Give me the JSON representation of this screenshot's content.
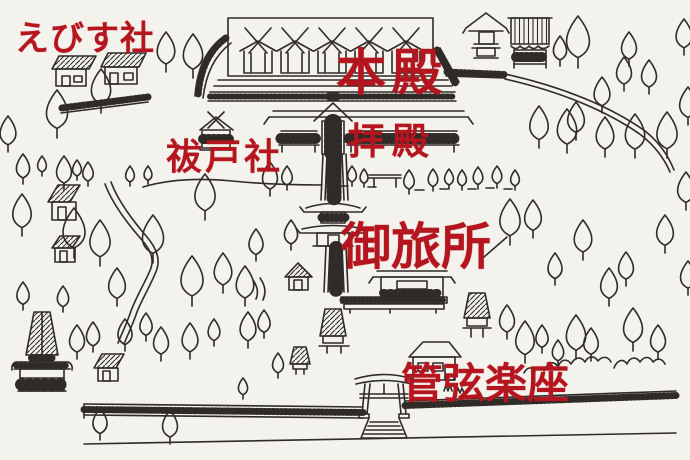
{
  "palette": {
    "background": "#f4f2ec",
    "ink": "#2e2b28",
    "label_red": "#b5151e"
  },
  "labels": {
    "ebisu_sha": "えびす社",
    "honden": "本殿",
    "haraedo_sha": "祓戸社",
    "haiden": "拝殿",
    "otabisho": "御旅所",
    "kangen_gakuza": "管弦楽座"
  }
}
